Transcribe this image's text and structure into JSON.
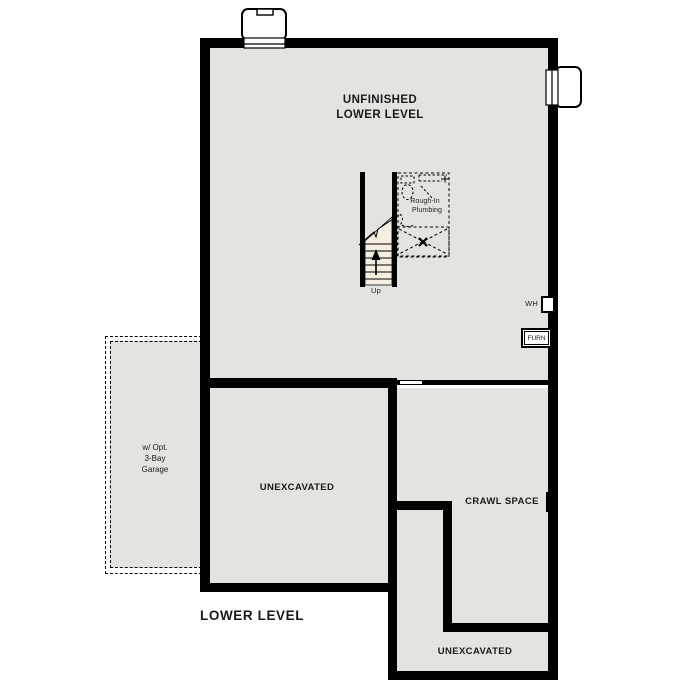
{
  "plan": {
    "title": "LOWER LEVEL",
    "main_room": {
      "line1": "UNFINISHED",
      "line2": "LOWER LEVEL"
    },
    "unexcavated_left": "UNEXCAVATED",
    "crawl_space": "CRAWL SPACE",
    "unexcavated_bottom": "UNEXCAVATED",
    "garage": {
      "line1": "w/ Opt.",
      "line2": "3-Bay",
      "line3": "Garage"
    },
    "stairs": {
      "up": "Up"
    },
    "plumbing": {
      "line1": "Rough-In",
      "line2": "Plumbing"
    },
    "water_heater": "WH",
    "furnace": "FURN"
  },
  "colors": {
    "wall": "#000000",
    "floor": "#e4e3e0",
    "stairs_fill": "#f5efe2",
    "background": "#ffffff"
  }
}
